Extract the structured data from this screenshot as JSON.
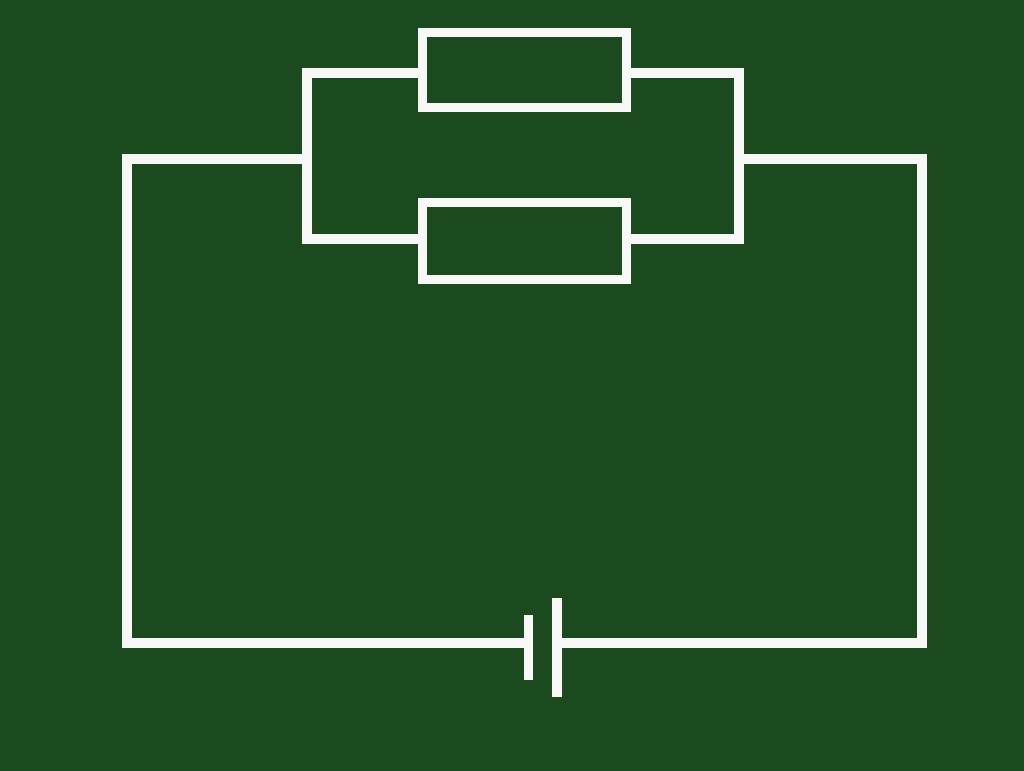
{
  "canvas": {
    "width": 1024,
    "height": 771,
    "background_color": "#1A4A1E"
  },
  "style": {
    "wire_color": "#F8F8F6",
    "wire_thickness": 10,
    "resistor_border": 9
  },
  "diagram": {
    "type": "circuit-schematic",
    "description": "Closed circuit loop with a battery (cell) at the bottom and two resistors connected in parallel at the top",
    "components": [
      {
        "name": "resistor-top",
        "kind": "resistor",
        "x": 418,
        "y": 28,
        "width": 213,
        "height": 84
      },
      {
        "name": "resistor-bottom",
        "kind": "resistor",
        "x": 418,
        "y": 198,
        "width": 213,
        "height": 86
      },
      {
        "name": "battery",
        "kind": "battery-cell",
        "plates": [
          {
            "name": "battery-plate-short",
            "polarity": "negative",
            "x": 524,
            "y": 615,
            "width": 9,
            "height": 65
          },
          {
            "name": "battery-plate-long",
            "polarity": "positive",
            "x": 552,
            "y": 598,
            "width": 10,
            "height": 99
          }
        ]
      }
    ],
    "wires": [
      {
        "name": "wire-left-vertical",
        "x": 122,
        "y": 154,
        "width": 10,
        "height": 494
      },
      {
        "name": "wire-top-left",
        "x": 122,
        "y": 154,
        "width": 190,
        "height": 10
      },
      {
        "name": "wire-top-right",
        "x": 734,
        "y": 154,
        "width": 193,
        "height": 10
      },
      {
        "name": "wire-right-vertical",
        "x": 917,
        "y": 154,
        "width": 10,
        "height": 494
      },
      {
        "name": "wire-bottom-left",
        "x": 122,
        "y": 638,
        "width": 402,
        "height": 10
      },
      {
        "name": "wire-bottom-right",
        "x": 562,
        "y": 638,
        "width": 365,
        "height": 10
      },
      {
        "name": "wire-parallel-left-vertical",
        "x": 302,
        "y": 68,
        "width": 10,
        "height": 176
      },
      {
        "name": "wire-parallel-right-vertical",
        "x": 734,
        "y": 68,
        "width": 10,
        "height": 176
      },
      {
        "name": "wire-branch-top-left",
        "x": 302,
        "y": 68,
        "width": 116,
        "height": 10
      },
      {
        "name": "wire-branch-top-right",
        "x": 631,
        "y": 68,
        "width": 103,
        "height": 10
      },
      {
        "name": "wire-branch-bottom-left",
        "x": 302,
        "y": 234,
        "width": 116,
        "height": 10
      },
      {
        "name": "wire-branch-bottom-right",
        "x": 631,
        "y": 234,
        "width": 103,
        "height": 10
      }
    ]
  }
}
